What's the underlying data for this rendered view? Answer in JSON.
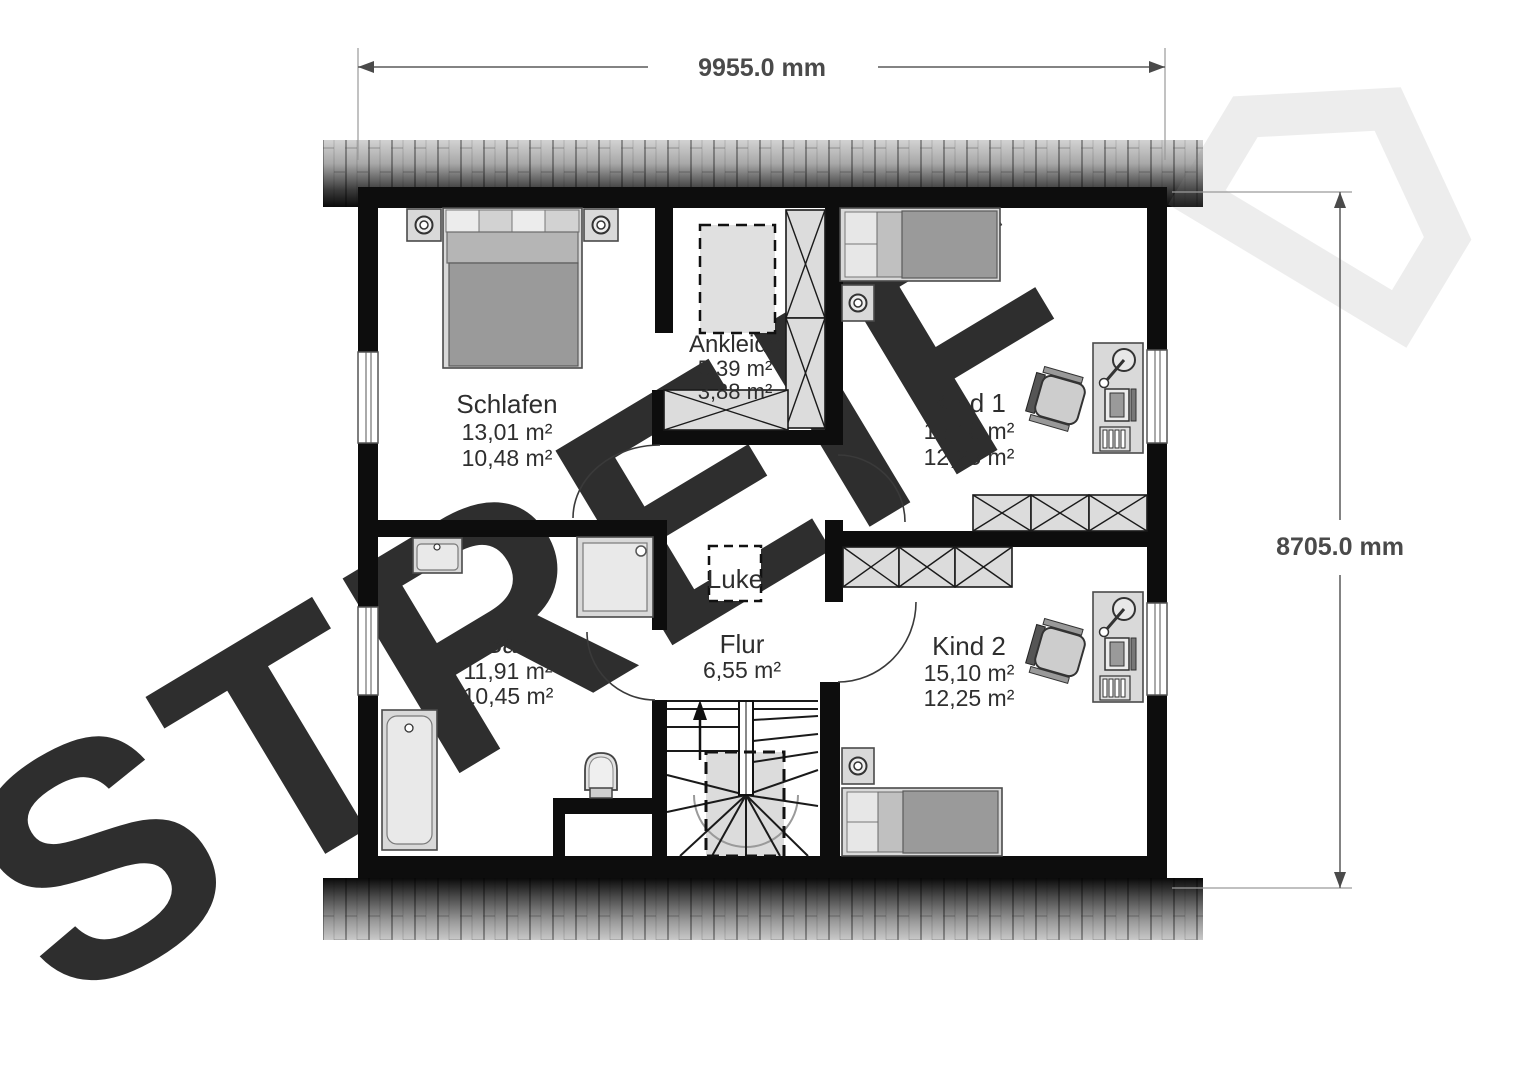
{
  "plan": {
    "dimension_top": "9955.0 mm",
    "dimension_right": "8705.0 mm",
    "watermark_text": "STREIF",
    "rooms": {
      "schlafen": {
        "name": "Schlafen",
        "area_total": "13,01 m²",
        "area_living": "10,48 m²"
      },
      "ankleide": {
        "name": "Ankleide",
        "area_total": "5,39 m²",
        "area_living": "3,88 m²"
      },
      "kind1": {
        "name": "Kind 1",
        "area_total": "15,10 m²",
        "area_living": "12,25 m²"
      },
      "bad": {
        "name": "Bad",
        "area_total": "11,91 m²",
        "area_living": "10,45 m²"
      },
      "flur": {
        "name": "Flur",
        "area_total": "6,55 m²"
      },
      "kind2": {
        "name": "Kind 2",
        "area_total": "15,10 m²",
        "area_living": "12,25 m²"
      },
      "luke": {
        "name": "Luke"
      }
    },
    "colors": {
      "wall": "#0d0d0d",
      "dimension": "#4a4a4a",
      "watermark": "rgba(141,141,141,0.16)",
      "furniture_light": "#d9d9d9",
      "furniture_dark": "#9a9a9a"
    }
  }
}
